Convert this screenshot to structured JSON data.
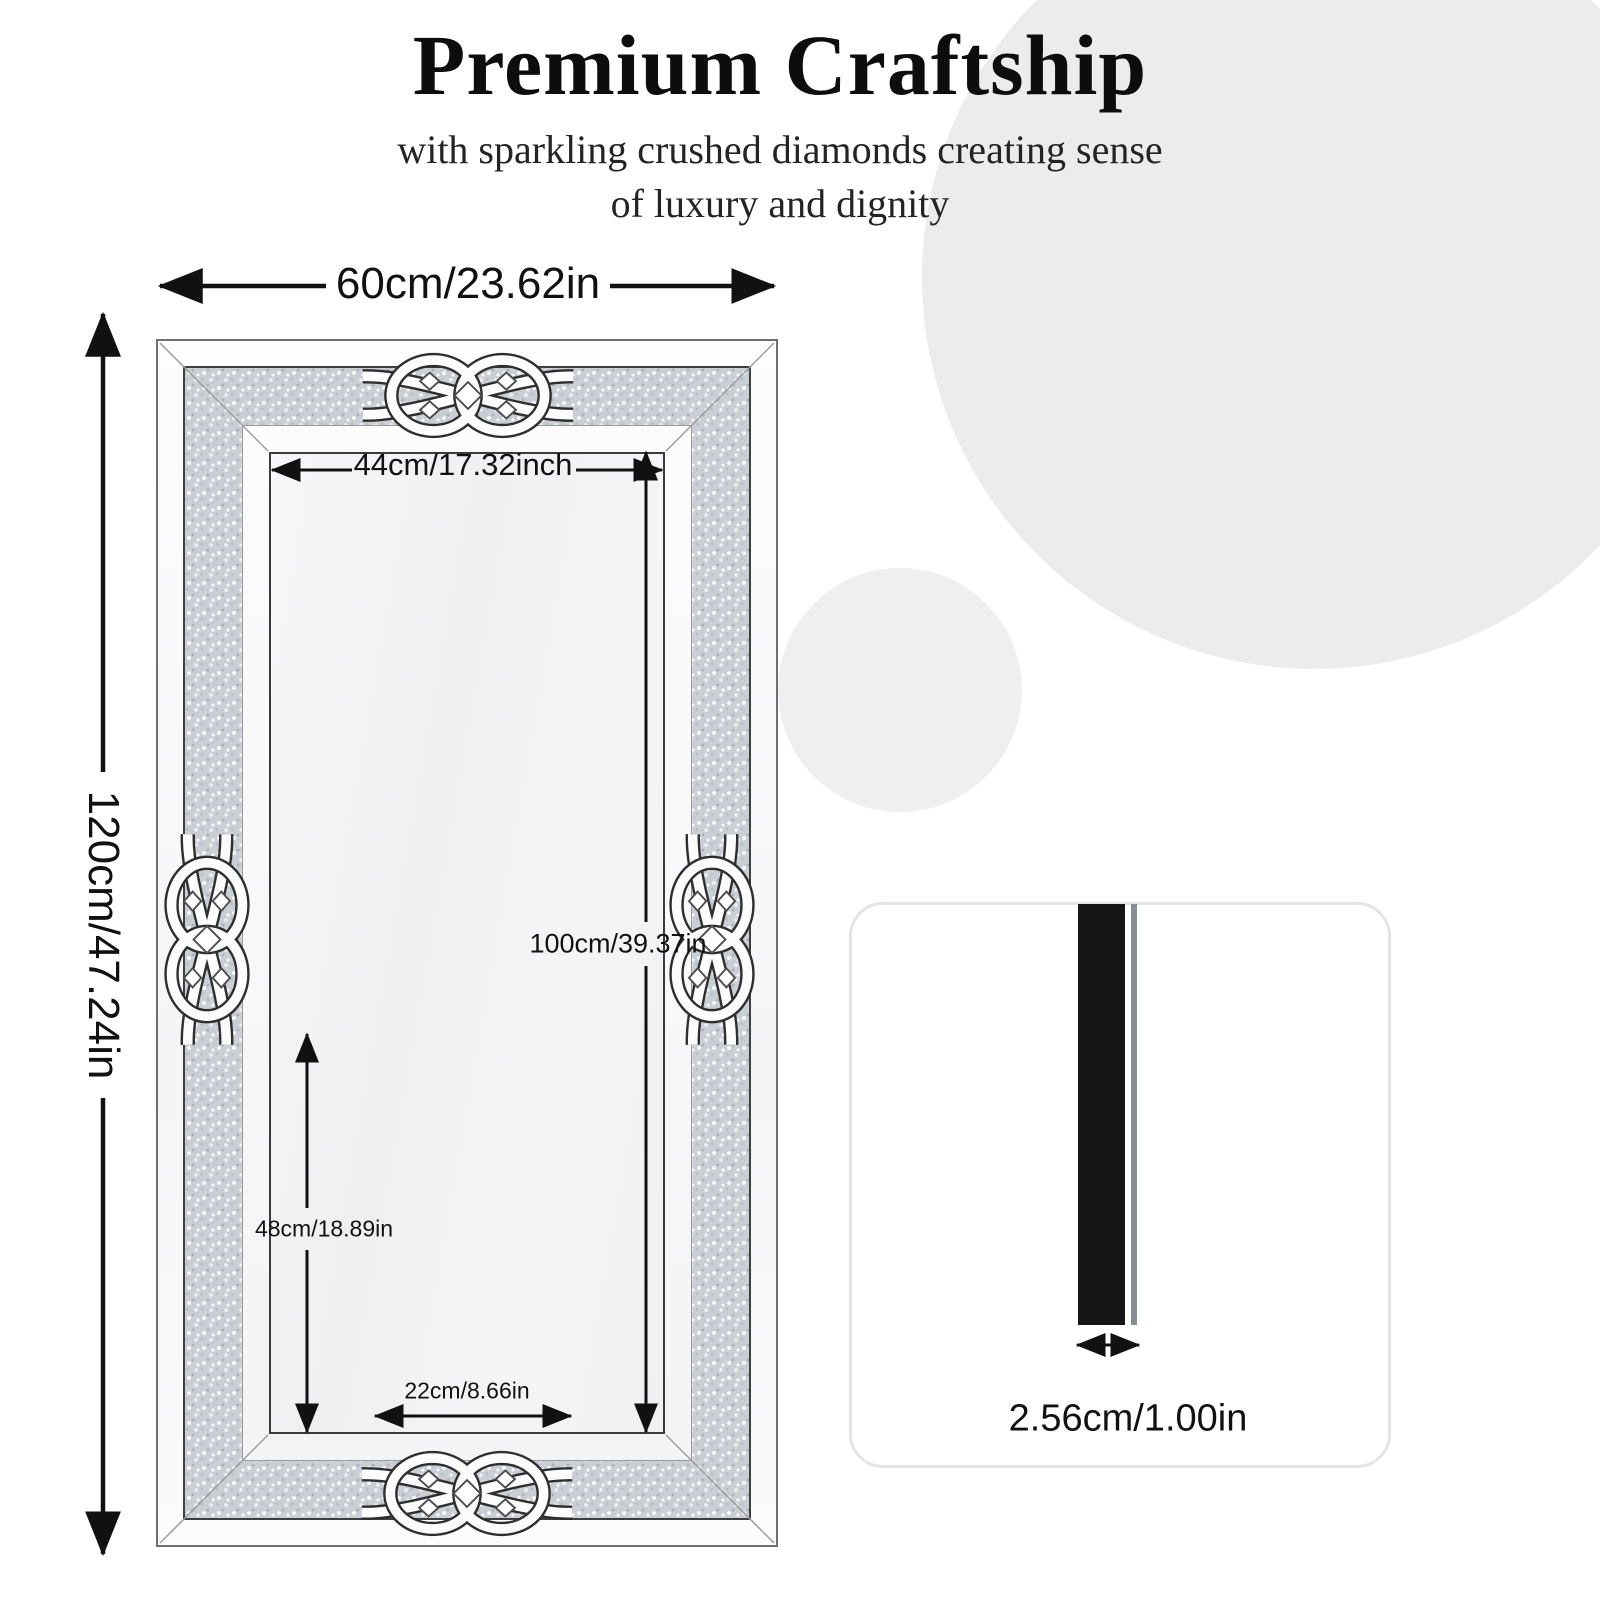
{
  "header": {
    "title": "Premium Craftship",
    "subtitle_line1": "with sparkling crushed diamonds creating sense",
    "subtitle_line2": "of luxury and dignity"
  },
  "mirror": {
    "outer_width_label": "60cm/23.62in",
    "outer_height_label": "120cm/47.24in",
    "inner_width_label": "44cm/17.32inch",
    "inner_height_label": "100cm/39.37in",
    "partial_height_label": "48cm/18.89in",
    "bottom_inner_width_label": "22cm/8.66in"
  },
  "side_profile": {
    "thickness_label": "2.56cm/1.00in"
  },
  "colors": {
    "background_circle": "#ececec",
    "diamond_band_base": "#c9cfd4",
    "frame_line": "#3f3f3f",
    "dimension_line": "#111111",
    "profile_bar": "#161616"
  }
}
